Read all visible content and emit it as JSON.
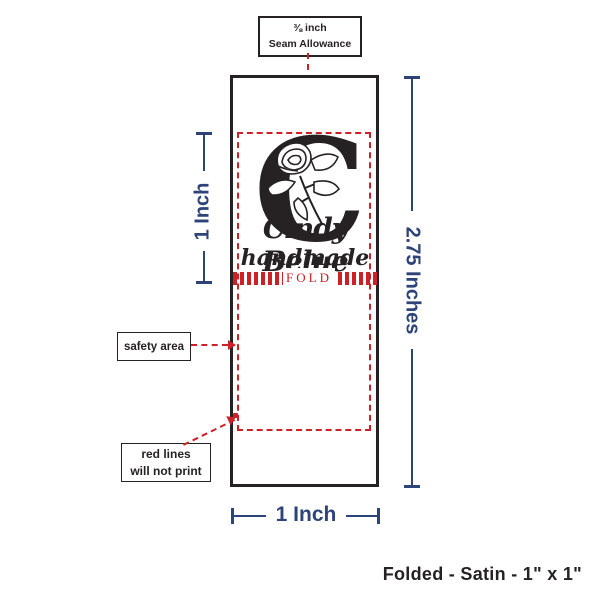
{
  "colors": {
    "navy": "#2e4377",
    "red": "#cc2127",
    "ink": "#262223"
  },
  "seam_callout": {
    "line1": "⅜ inch",
    "line2": "Seam Allowance"
  },
  "label_design": {
    "monogram_letter": "C",
    "monogram_icon": "flower-monogram",
    "brand_name": "Cindy Belue",
    "brand_subtitle": "handmade",
    "fold_text": "FOLD"
  },
  "measurements": {
    "inner_height": "1 Inch",
    "total_height": "2.75 Inches",
    "width": "1 Inch"
  },
  "callouts": {
    "safety_area": "safety area",
    "red_lines_line1": "red lines",
    "red_lines_line2": "will not print"
  },
  "footer_note": "Folded - Satin - 1\" x 1\""
}
